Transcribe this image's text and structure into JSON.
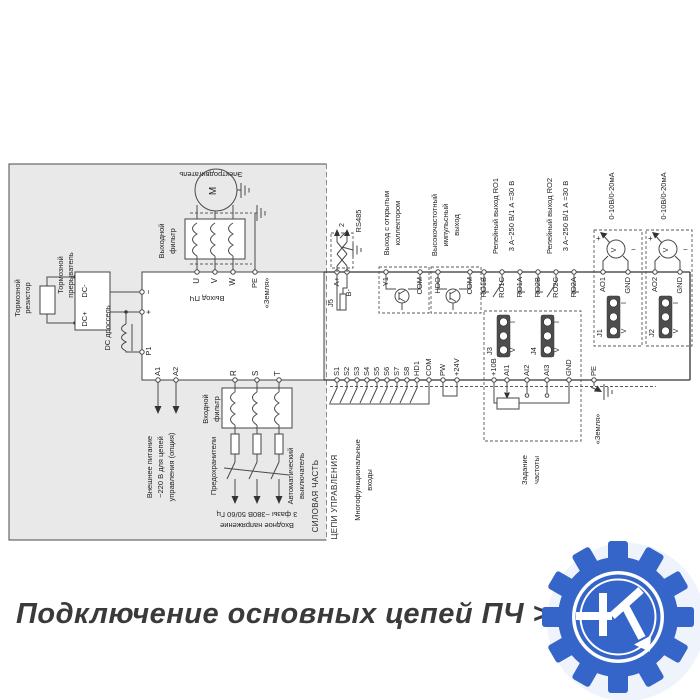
{
  "caption": "Подключение основных цепей ПЧ > 37 кВт",
  "colors": {
    "logo_blue": "#3565c8",
    "power_bg": "#e9e9e9",
    "line": "#4a4a4a"
  },
  "sections": {
    "power": "СИЛОВАЯ ЧАСТЬ",
    "control": "ЦЕПИ УПРАВЛЕНИЯ"
  },
  "power": {
    "brake_resistor": {
      "l1": "Тормозной",
      "l2": "резистор"
    },
    "brake_chopper": {
      "l1": "Тормозной",
      "l2": "прерыватель",
      "dc_minus": "DC-",
      "dc_plus": "DC+"
    },
    "dc_choke": "DC дроссель",
    "inverter": {
      "minus": "−",
      "plus": "+",
      "p1": "P1",
      "a1": "A1",
      "a2": "A2",
      "u": "U",
      "v": "V",
      "w": "W",
      "pe": "PE",
      "r": "R",
      "s": "S",
      "t": "T",
      "output": "Выход ПЧ",
      "ground": "«Земля»"
    },
    "ext_power": {
      "l1": "Внешнее питание",
      "l2": "~220 В для цепей",
      "l3": "управления (опция)"
    },
    "output_filter": {
      "l1": "Выходной",
      "l2": "фильтр"
    },
    "motor": {
      "label": "Электродвигатель",
      "m": "M"
    },
    "input_filter": {
      "l1": "Входной",
      "l2": "фильтр"
    },
    "fuses": "Предохранители",
    "breaker": {
      "l1": "Автоматический",
      "l2": "выключатель"
    },
    "input_voltage": {
      "l1": "Входное напряжение",
      "l2": "3 фазы ~380В 50/60 Гц"
    }
  },
  "control": {
    "rs485": {
      "label": "RS485",
      "a": "A+",
      "b": "B-",
      "j5": "J5",
      "n": "2"
    },
    "oc": {
      "l1": "Выход с открытым",
      "l2": "коллектором",
      "t1": "Y1",
      "t2": "COM"
    },
    "hf": {
      "l1": "Высокочастотный",
      "l2": "импульсный",
      "l3": "выход",
      "t1": "HDO",
      "t2": "COM"
    },
    "ro1": {
      "l1": "Релейный выход RO1",
      "l2": "3 А~250 В/1 А =30 В",
      "b": "RO1B",
      "c": "RO1C",
      "a": "RO1A"
    },
    "ro2": {
      "l1": "Релейный выход RO2",
      "l2": "3 А~250 В/1 А =30 В",
      "b": "RO2B",
      "c": "RO2C",
      "a": "RO2A"
    },
    "ao1": {
      "label": "0-10В/0-20мА",
      "t": "AO1",
      "gnd": "GND",
      "j": "J1",
      "v": "V",
      "plus": "+",
      "minus": "−"
    },
    "ao2": {
      "label": "0-10В/0-20мА",
      "t": "AO2",
      "gnd": "GND",
      "j": "J2",
      "v": "V",
      "plus": "+",
      "minus": "−"
    },
    "din": {
      "l1": "Многофункциональные",
      "l2": "входы",
      "s": [
        "S1",
        "S2",
        "S3",
        "S4",
        "S5",
        "S6",
        "S7",
        "S8"
      ],
      "hd1": "HD1",
      "com": "COM",
      "pw": "PW",
      "v24": "+24V"
    },
    "freq": {
      "l1": "Задание",
      "l2": "частоты",
      "v10": "+10В",
      "ai1": "AI1",
      "ai2": "AI2",
      "ai3": "AI3",
      "gnd": "GND",
      "j3": "J3",
      "j4": "J4",
      "i": "I",
      "v": "V"
    },
    "pe": "PE",
    "ground": "«Земля»"
  }
}
